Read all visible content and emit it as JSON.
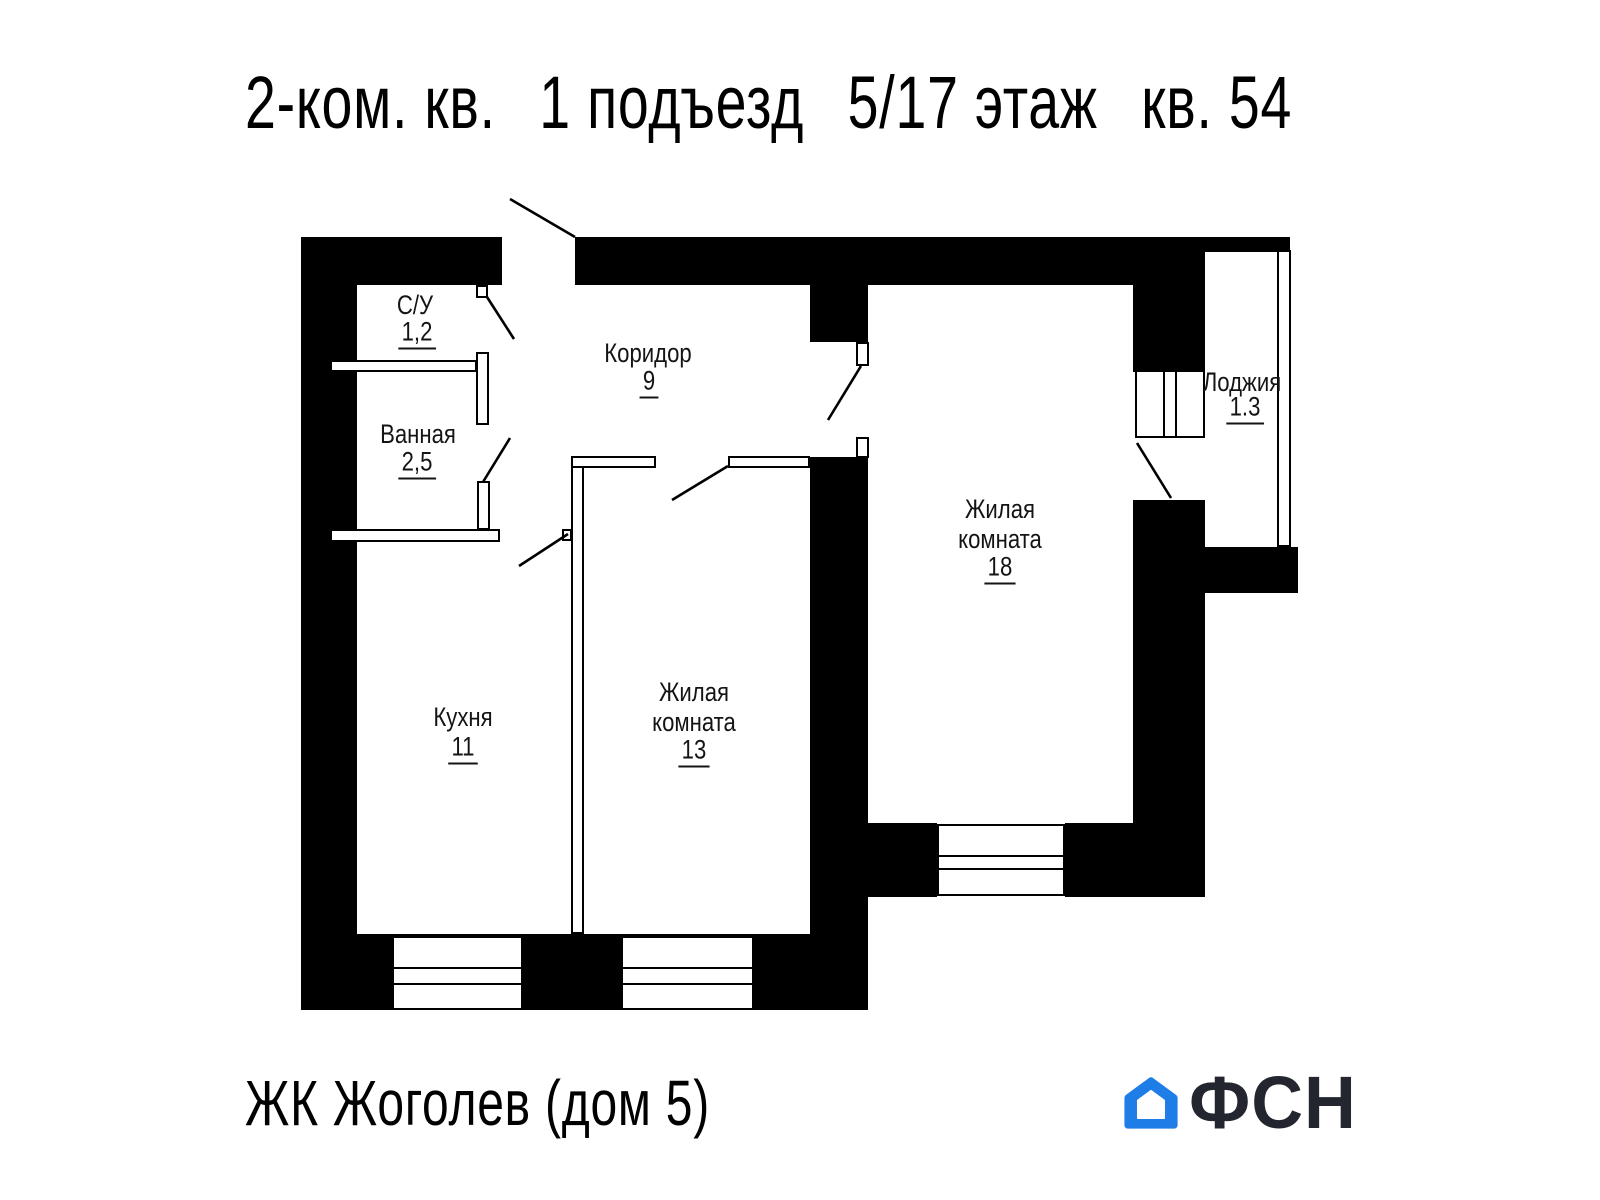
{
  "title": {
    "parts": [
      "2-ком. кв.",
      "1 подъезд",
      "5/17 этаж",
      "кв. 54"
    ]
  },
  "rooms": {
    "su": {
      "name": "С/У",
      "area": "1,2"
    },
    "bath": {
      "name": "Ванная",
      "area": "2,5"
    },
    "corridor": {
      "name": "Коридор",
      "area": "9"
    },
    "kitchen": {
      "name": "Кухня",
      "area": "11"
    },
    "room13": {
      "name": "Жилая\nкомната",
      "area": "13"
    },
    "room18": {
      "name": "Жилая\nкомната",
      "area": "18"
    },
    "loggia": {
      "name": "Лоджия",
      "area": "1.3"
    }
  },
  "footer": {
    "project": "ЖК Жоголев (дом 5)",
    "logo_text": "ФСН"
  },
  "colors": {
    "walls": "#000000",
    "logo_blue": "#1e7de6",
    "logo_text": "#23262e"
  }
}
